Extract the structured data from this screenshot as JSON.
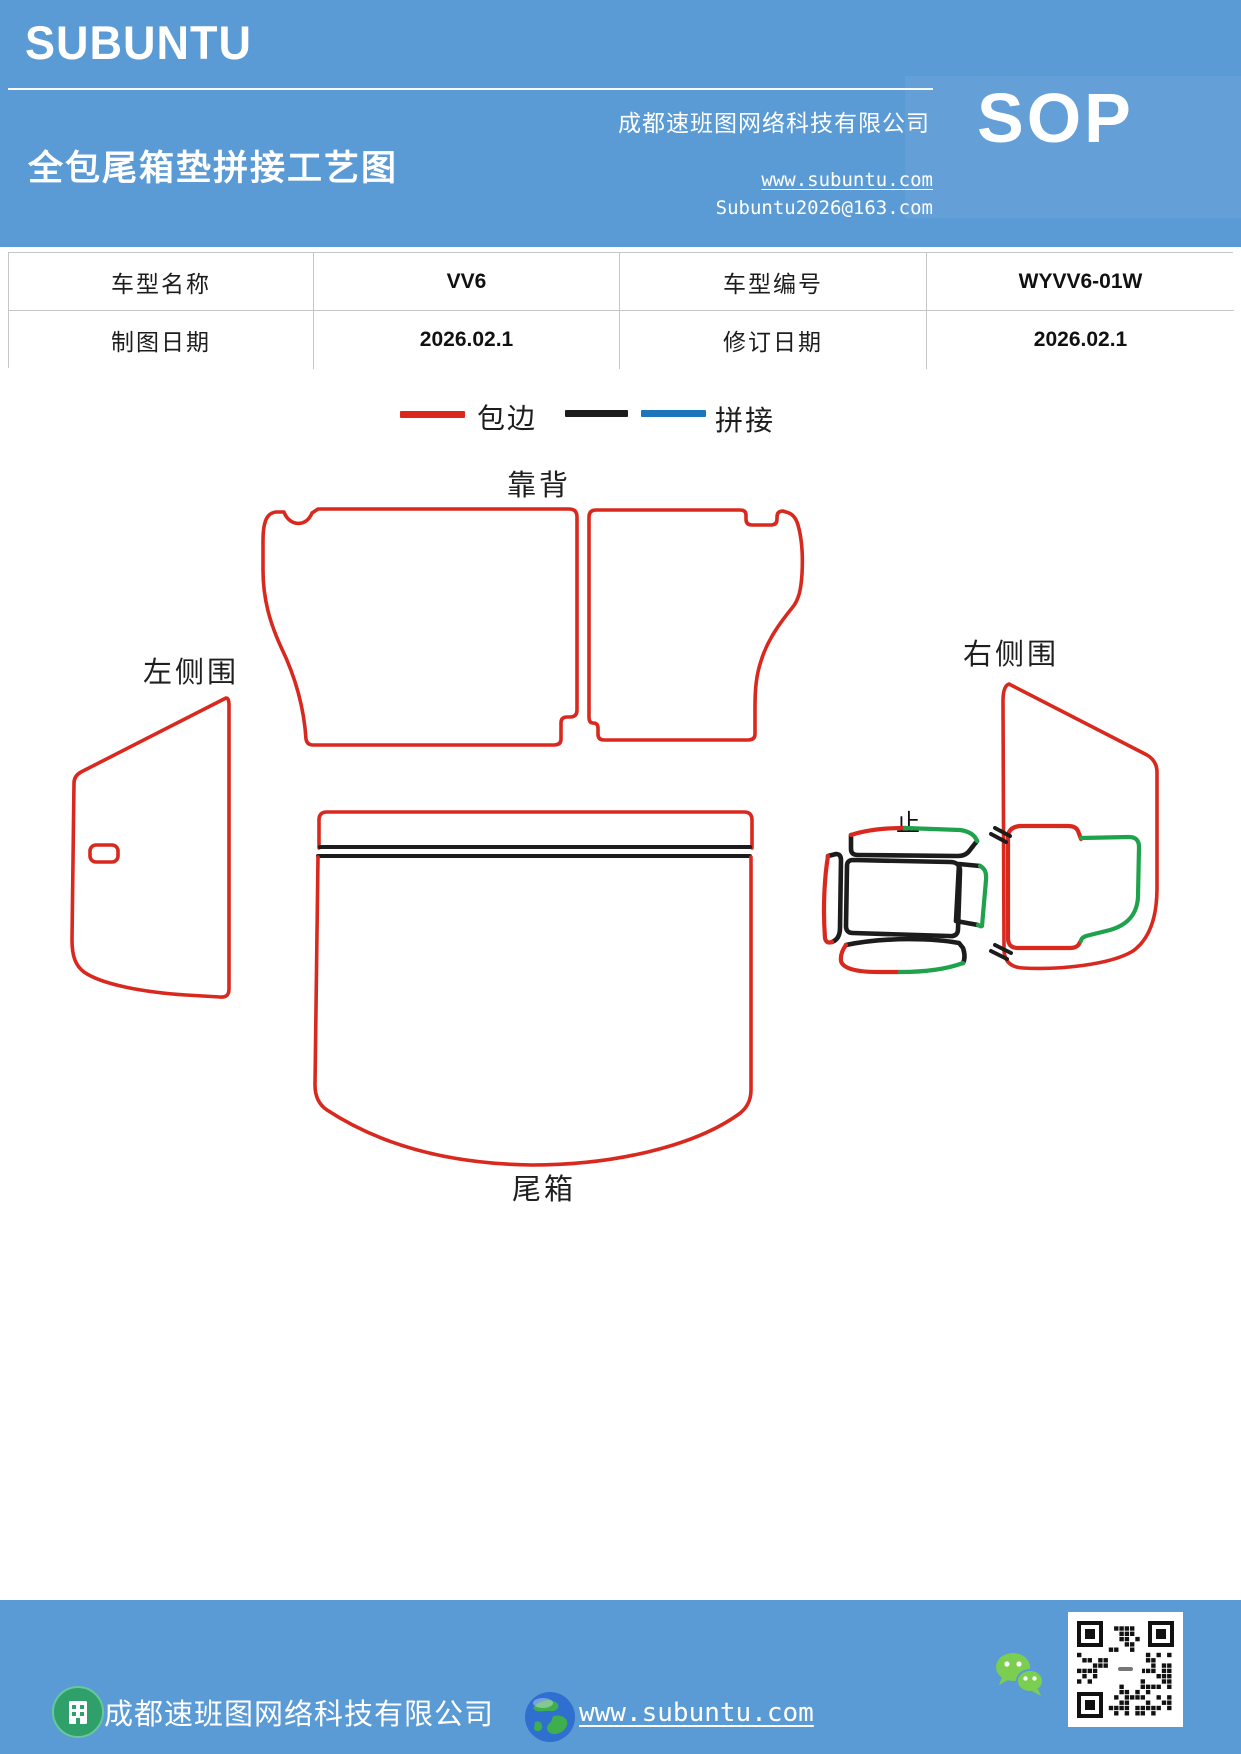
{
  "header": {
    "logo": "SUBUNTU",
    "title": "全包尾箱垫拼接工艺图",
    "company": "成都速班图网络科技有限公司",
    "website": "www.subuntu.com",
    "email": "Subuntu2026@163.com",
    "sop": "SOP"
  },
  "info_table": {
    "rows": [
      {
        "label1": "车型名称",
        "value1": "VV6",
        "label2": "车型编号",
        "value2": "WYVV6-01W"
      },
      {
        "label1": "制图日期",
        "value1": "2026.02.1",
        "label2": "修订日期",
        "value2": "2026.02.1"
      }
    ]
  },
  "legend": {
    "binding_label": "包边",
    "splice_label": "拼接"
  },
  "diagram": {
    "labels": {
      "backrest": "靠背",
      "left_side": "左侧围",
      "right_side": "右侧围",
      "trunk": "尾箱",
      "stop": "止"
    }
  },
  "footer": {
    "company": "成都速班图网络科技有限公司",
    "website": "www.subuntu.com"
  },
  "colors": {
    "header_blue": "#5B9BD5",
    "binding_red": "#D9291F",
    "splice_black": "#1C1C1C",
    "splice_blue": "#1B75BC",
    "part_green": "#1FA24C",
    "wechat_green": "#7BCE4F",
    "table_border": "#C6C6C6"
  }
}
